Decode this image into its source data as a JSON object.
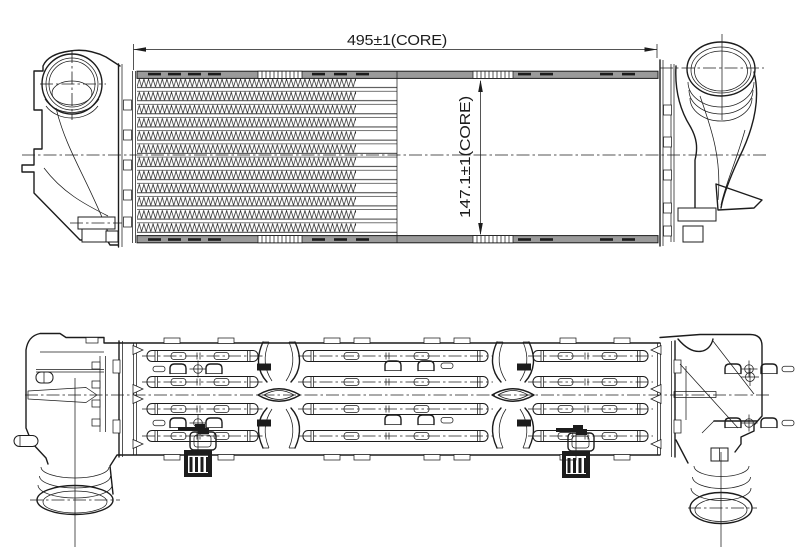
{
  "drawing": {
    "dimensions": {
      "core_width": {
        "label": "495±1(CORE)"
      },
      "core_height": {
        "label": "147.1±1(CORE)"
      }
    },
    "colors": {
      "line": "#1c1c1c",
      "plate_fill": "#9a9a9a",
      "background": "#ffffff"
    }
  }
}
